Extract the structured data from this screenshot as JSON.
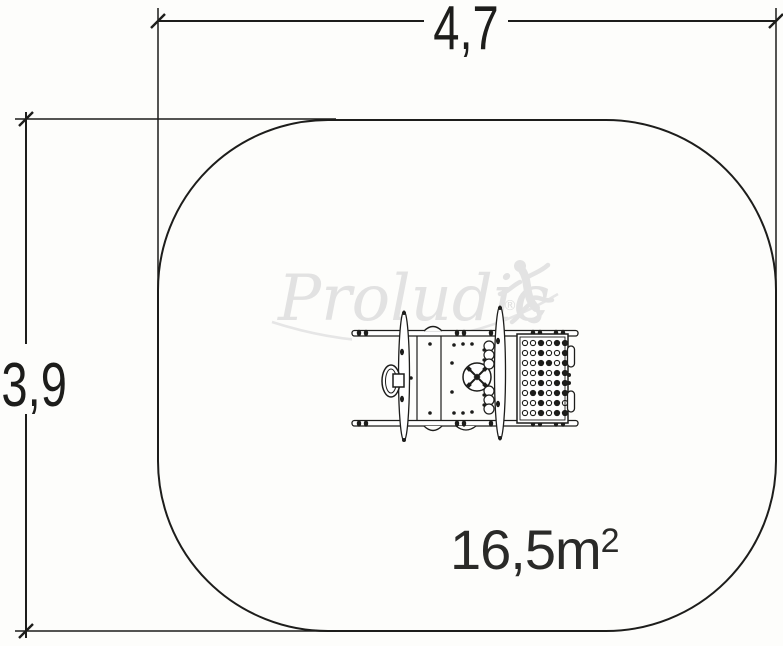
{
  "page": {
    "background": "#fdfdfb"
  },
  "drawing": {
    "title": "playground equipment plan view with safety area",
    "dimension_width": {
      "label": "4,7"
    },
    "dimension_height": {
      "label": "3,9"
    },
    "area": {
      "value": "16,5m",
      "exponent": "2"
    },
    "watermark": {
      "brand": "Proludic",
      "registered_mark": "®"
    },
    "colors": {
      "line": "#1d1d1b",
      "watermark": "#e2e2e2",
      "background": "#fdfdfb"
    },
    "equipment": {
      "platform_hole_pattern": [
        "oofoff",
        "oofoof",
        "ooffof",
        "oofoff",
        "oofoff",
        "offoff",
        "oofofo",
        "oofoff"
      ]
    }
  }
}
